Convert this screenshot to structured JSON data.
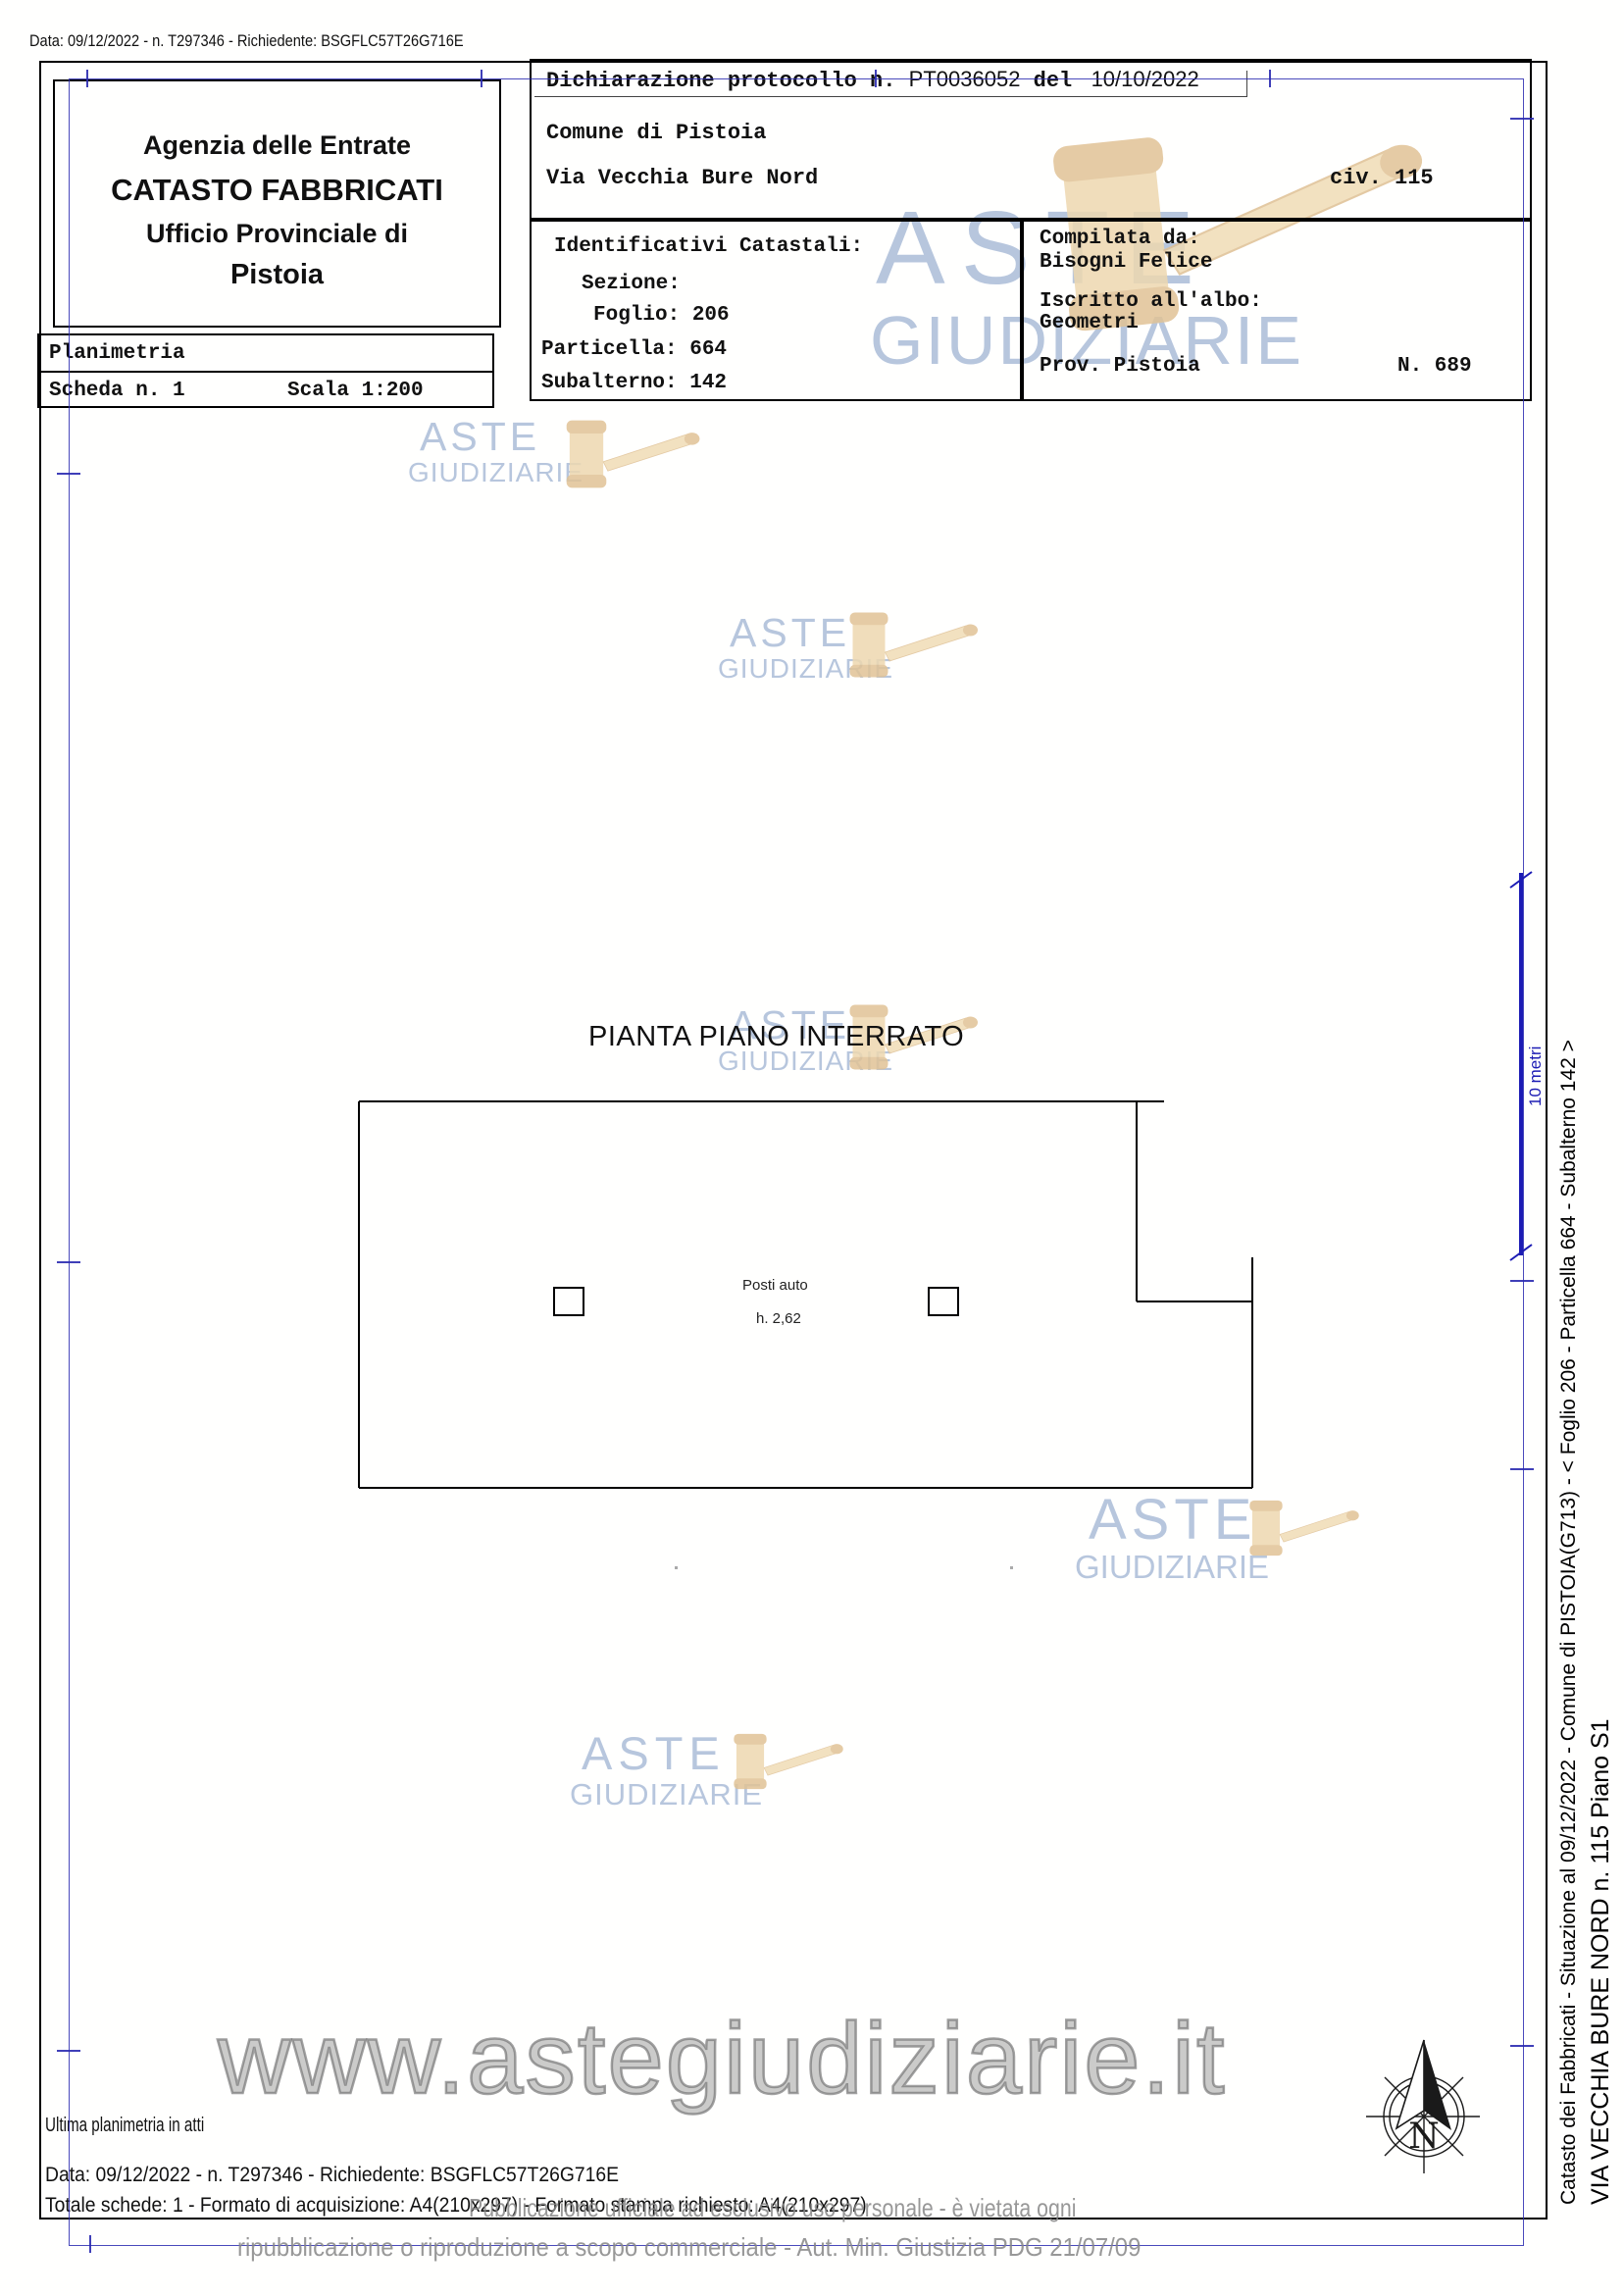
{
  "page": {
    "top_line": "Data: 09/12/2022 - n. T297346 - Richiedente: BSGFLC57T26G716E"
  },
  "header": {
    "line1": "Agenzia delle Entrate",
    "line2": "CATASTO FABBRICATI",
    "line3": "Ufficio Provinciale di",
    "line4": "Pistoia"
  },
  "declaration": {
    "label": "Dichiarazione protocollo n. ",
    "protocol": "PT0036052",
    "del": " del ",
    "date": " 10/10/2022",
    "comune": "Comune di Pistoia",
    "street": "Via Vecchia Bure Nord",
    "civ": "civ. 115"
  },
  "identificativi": {
    "title": "Identificativi Catastali:",
    "sezione": "Sezione:",
    "foglio": "Foglio: 206",
    "particella": "Particella: 664",
    "subalterno": "Subalterno: 142"
  },
  "compilata": {
    "label": "Compilata da:",
    "name": "Bisogni Felice",
    "albo_label": "Iscritto all'albo:",
    "albo": "Geometri",
    "prov": "Prov. Pistoia",
    "num": "N. 689"
  },
  "planimetria": {
    "title": "Planimetria",
    "scheda": "Scheda n. 1",
    "scala": "Scala 1:200"
  },
  "plan": {
    "title": "PIANTA PIANO INTERRATO",
    "room_label": "Posti auto",
    "height_label": "h. 2,62",
    "scale_label": "10 metri"
  },
  "sidebar": {
    "line1": "Catasto dei Fabbricati - Situazione al 09/12/2022 - Comune di PISTOIA(G713) - <  Foglio 206 - Particella 664 - Subalterno 142 >",
    "line2": "VIA VECCHIA BURE NORD n. 115 Piano S1"
  },
  "footer": {
    "ultima": "Ultima planimetria in atti",
    "data_line": "Data: 09/12/2022 - n. T297346 - Richiedente: BSGFLC57T26G716E",
    "totale": "Totale schede: 1 - Formato di acquisizione: A4(210x297) - Formato stampa richiesto: A4(210x297)"
  },
  "watermark": {
    "line1": "ASTE",
    "line2": "GIUDIZIARIE",
    "url": "www.astegiudiziarie.it",
    "disclaimer1": "Pubblicazione ufficiale ad esclusivo uso personale - è vietata ogni",
    "disclaimer2": "ripubblicazione o riproduzione a scopo commerciale - Aut. Min. Giustizia PDG 21/07/09",
    "text_color": "#a6b9d6",
    "gavel_color": "#e9d2ab"
  },
  "compass": {
    "label": "N"
  },
  "colors": {
    "frame": "#000000",
    "sheet_line": "#2a2ab0",
    "dimension_blue": "#1c1cb4"
  }
}
